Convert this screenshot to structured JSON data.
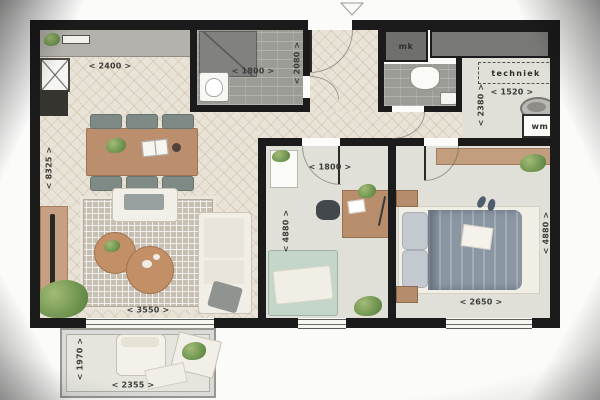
{
  "labels": {
    "kitchen_width": "< 2400 >",
    "bath_width": "< 1800 >",
    "bath_depth": "< 2080 >",
    "mk": "mk",
    "techniek": "techniek",
    "tech_width": "< 1520 >",
    "tech_depth": "< 2380 >",
    "wm": "wm",
    "living_depth": "< 8325 >",
    "living_width": "< 3550 >",
    "study_width": "< 1800 >",
    "study_depth": "< 4880 >",
    "bedroom_width": "< 2650 >",
    "bedroom_depth": "< 4880 >",
    "balcony_depth": "< 1970 >",
    "balcony_width": "< 2355 >"
  },
  "colors": {
    "wall": "#1b1b1b",
    "floor_wood": "#e9e2d6",
    "floor_tile": "#9c9c97",
    "floor_soft": "#e0e0d8",
    "accent_wood": "#bb8f6e",
    "duvet": "#8b96a3",
    "mint": "#c4d5ca"
  }
}
